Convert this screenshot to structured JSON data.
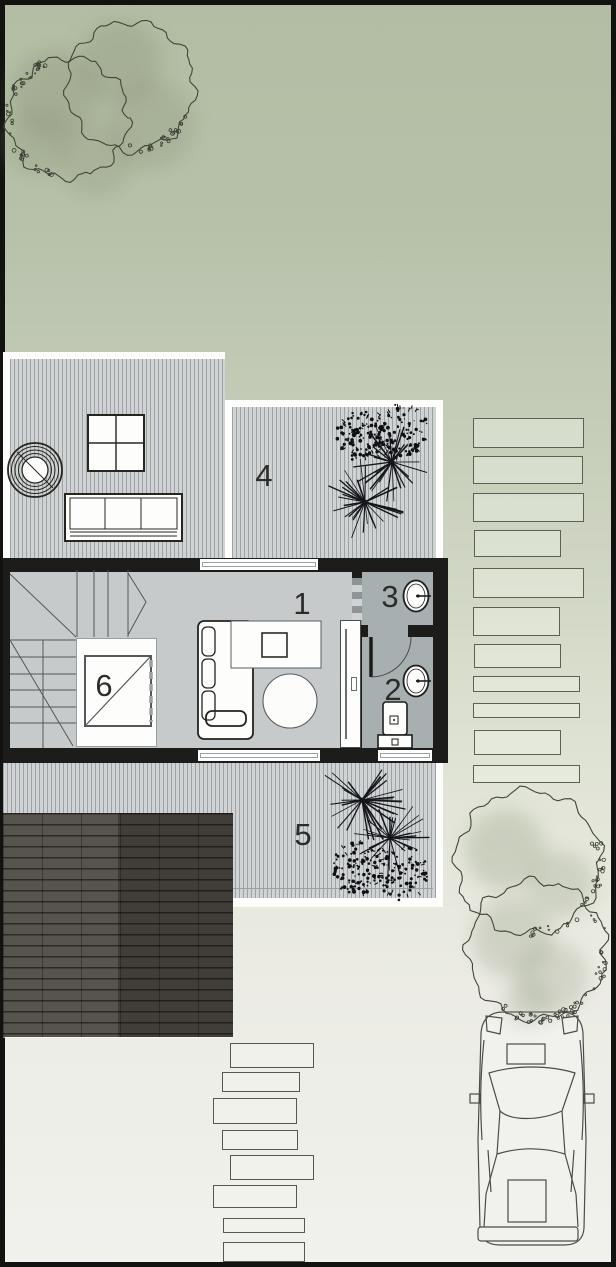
{
  "drawing": {
    "type": "architectural-site-floor-plan",
    "view": "top-down"
  },
  "room_labels": [
    {
      "number": "1",
      "name": "living-room"
    },
    {
      "number": "2",
      "name": "bathroom"
    },
    {
      "number": "3",
      "name": "wc"
    },
    {
      "number": "4",
      "name": "upper-deck-terrace"
    },
    {
      "number": "5",
      "name": "lower-deck-terrace"
    },
    {
      "number": "6",
      "name": "stair-void"
    }
  ],
  "site_elements": {
    "stepping_stones_right": 11,
    "stepping_stones_bottom": 8,
    "trees_top_left": 2,
    "trees_bottom_right": 2,
    "vehicle": "car-top-view",
    "deck_plants": 4
  },
  "colors": {
    "lawn_top": "#b2bda3",
    "lawn_mid": "#dfe3d4",
    "paving_bottom": "#f1f1ed",
    "deck_boards": "#cfd3d4",
    "wall": "#1c1c1a",
    "room_floor": "#c6cacb",
    "wet_room_floor": "#a7afb1",
    "roof_light_band": "#57534d",
    "roof_dark_band": "#413d38",
    "line_work": "#3a3f37"
  }
}
